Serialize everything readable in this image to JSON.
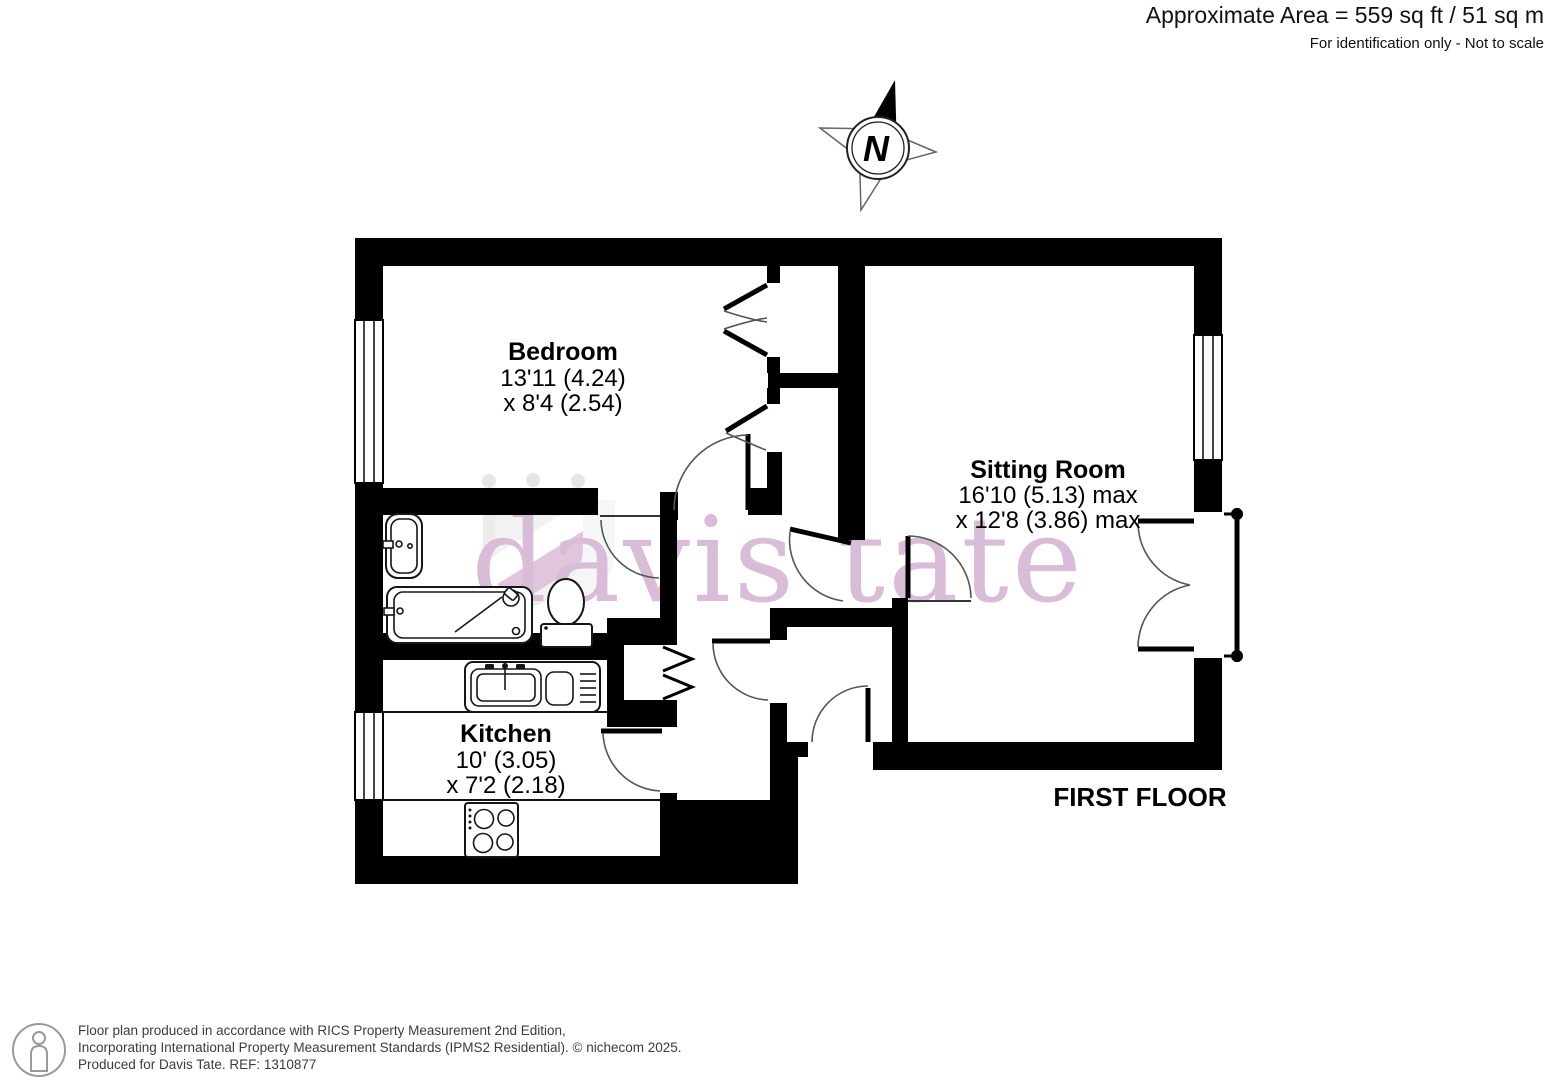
{
  "header": {
    "area_line": "Approximate Area = 559 sq ft / 51 sq m",
    "note_line": "For identification only - Not to scale"
  },
  "compass": {
    "label": "N"
  },
  "watermark": {
    "text": "davis tate"
  },
  "floor_label": "FIRST FLOOR",
  "rooms": {
    "bedroom": {
      "name": "Bedroom",
      "dim1": "13'11 (4.24)",
      "dim2": "x 8'4 (2.54)"
    },
    "sitting_room": {
      "name": "Sitting Room",
      "dim1": "16'10 (5.13) max",
      "dim2": "x 12'8 (3.86) max"
    },
    "kitchen": {
      "name": "Kitchen",
      "dim1": "10' (3.05)",
      "dim2": "x 7'2 (2.18)"
    }
  },
  "footer": {
    "line1": "Floor plan produced in accordance with RICS Property Measurement 2nd Edition,",
    "line2": "Incorporating International Property Measurement Standards (IPMS2 Residential).   © nichecom 2025.",
    "line3": "Produced for Davis Tate.   REF: 1310877"
  },
  "colors": {
    "wall": "#000000",
    "watermark_pink": "#d9bcd7",
    "shield_gray": "#ececec",
    "band_pink": "#dfc5dd",
    "footer_icon_gray": "#9a9a9a"
  }
}
